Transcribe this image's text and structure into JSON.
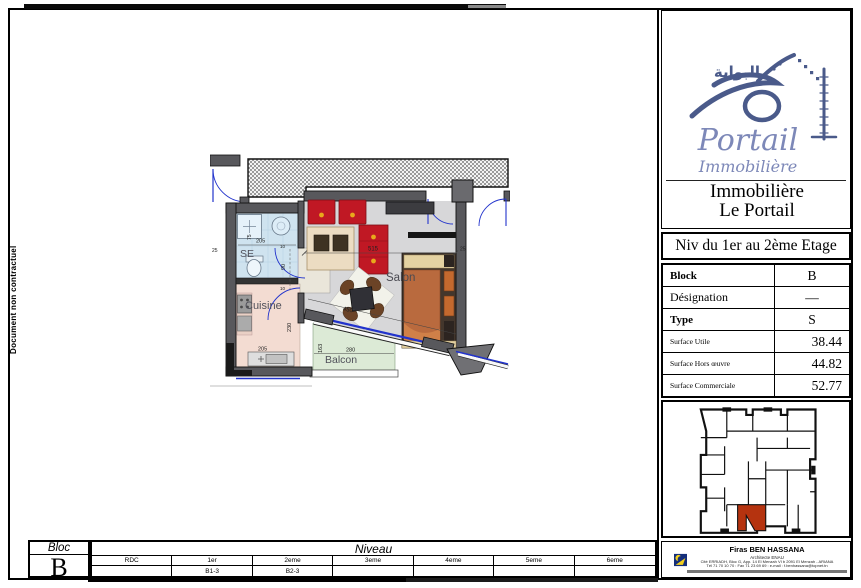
{
  "note": {
    "vertical_text": "Document non contractuel"
  },
  "brand": {
    "arabic_calligraphy": "البوابة",
    "script_name": "Portail",
    "script_subtitle": "Immobilière",
    "company_line1": "Immobilière",
    "company_line2": "Le Portail"
  },
  "level_title": "Niv du 1er au 2ème Etage",
  "spec_table": {
    "rows": [
      {
        "label": "Block",
        "value": "B"
      },
      {
        "label": "Désignation",
        "value": "—"
      },
      {
        "label": "Type",
        "value": "S"
      },
      {
        "label": "Surface Utile",
        "value": "38.44"
      },
      {
        "label": "Surface Hors œuvre",
        "value": "44.82"
      },
      {
        "label": "Surface Commerciale",
        "value": "52.77"
      }
    ]
  },
  "floor_plan": {
    "rooms": {
      "se": "SE",
      "cuisine": "Cuisine",
      "salon": "Salon",
      "balcon": "Balcon"
    },
    "dimensions": {
      "entry_width": "205",
      "entry_side": "75",
      "hall_width": "90",
      "wall_a": "10",
      "wall_b": "10",
      "salon_width": "515",
      "salon_right": "25",
      "salon_left": "25",
      "salon_diagonal": "450",
      "cuisine_depth": "230",
      "cuisine_width": "205",
      "balcon_depth": "163",
      "balcon_width": "280"
    },
    "colors": {
      "wall": "#58585c",
      "door": "#2233cc",
      "se_floor": "#cfe3ef",
      "cuisine_floor": "#f3dcd2",
      "salon_floor": "#d7d7d9",
      "balcon_floor": "#dcead6"
    }
  },
  "key_plan": {
    "highlight_color": "#b5330f"
  },
  "bloc_box": {
    "label": "Bloc",
    "value": "B"
  },
  "niveau_table": {
    "title": "Niveau",
    "columns": [
      "RDC",
      "1er",
      "2eme",
      "3eme",
      "4eme",
      "5eme",
      "6eme"
    ],
    "values": [
      "",
      "B1-3",
      "B2-3",
      "",
      "",
      "",
      ""
    ]
  },
  "architect": {
    "name": "Firas BEN HASSANA",
    "role": "Architecte ENAU",
    "address": "Cité ERRIADH, Bloc G, App. 14 El Menzah VI b 2091 El Menzah - ARIANA",
    "contact": "Tél 71 70 10 70 : Fax 71 23 69 69 : e-mail : f.benhassana@topnet.tn"
  }
}
